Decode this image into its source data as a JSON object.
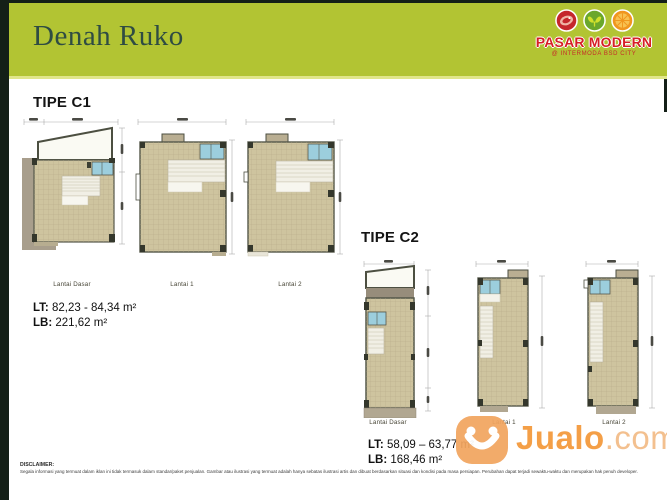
{
  "header": {
    "title": "Denah Ruko",
    "brand_name": "PASAR MODERN",
    "brand_subtitle": "@ INTERMODA BSD CITY",
    "brand_icons": [
      "meat-icon",
      "leaf-icon",
      "citrus-icon"
    ]
  },
  "type_c1": {
    "heading": "TIPE C1",
    "plan_labels": [
      "Lantai Dasar",
      "Lantai 1",
      "Lantai 2"
    ],
    "lt_label": "LT:",
    "lt_value": "82,23 - 84,34 m²",
    "lb_label": "LB:",
    "lb_value": "221,62 m²"
  },
  "type_c2": {
    "heading": "TIPE C2",
    "plan_labels": [
      "Lantai Dasar",
      "Lantai 1",
      "Lantai 2"
    ],
    "lt_label": "LT:",
    "lt_value": "58,09 – 63,77 m²",
    "lb_label": "LB:",
    "lb_value": "168,46 m²"
  },
  "watermark": {
    "name": "Jualo",
    "domain": ".com"
  },
  "disclaimer": {
    "title": "DISCLAIMER:",
    "body": "Segala informasi yang termuat dalam iklan ini tidak termasuk dalam standar/paket penjualan. Gambar atau ilustrasi yang termuat adalah hanya sebatas ilustrasi artis dan dibuat berdasarkan situasi dan kondisi pada masa persiapan. Perubahan dapat terjadi sewaktu-waktu dan merupakan hak penuh developer."
  },
  "colors": {
    "header_green": "#b2c433",
    "frame_dark": "#141f17",
    "brand_red": "#d61f26",
    "floor_tan": "#cec49f",
    "bath_blue": "#9ccedd",
    "watermark_orange": "#f49a3e"
  }
}
